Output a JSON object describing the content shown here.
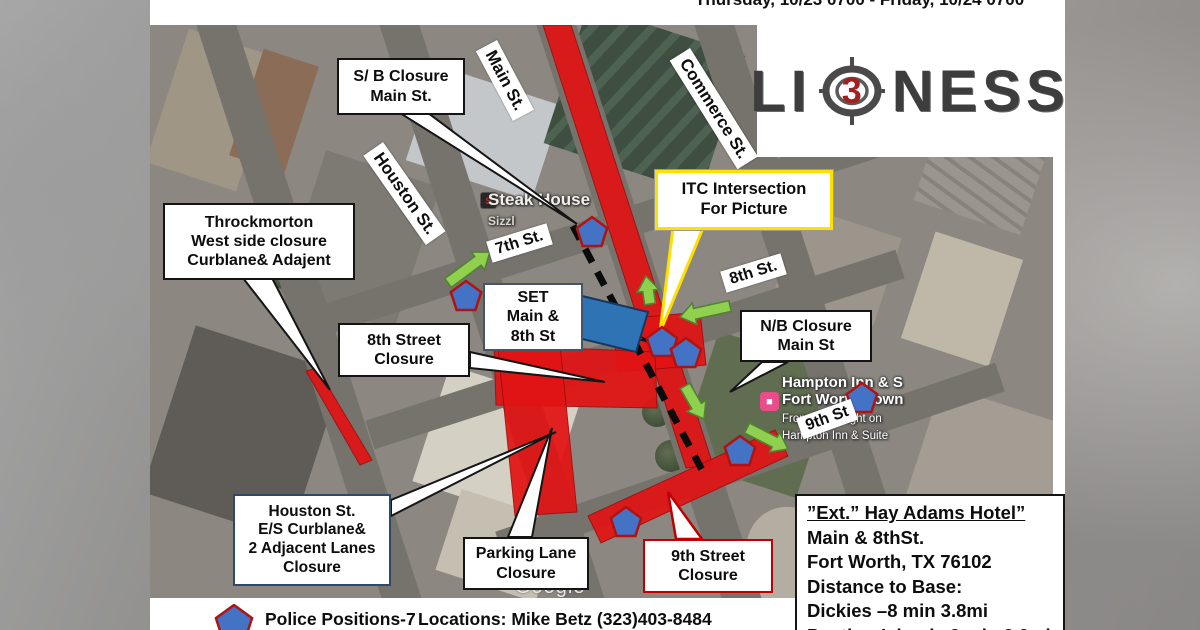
{
  "header": {
    "schedule": "Thursday, 10/23 0700 - Friday, 10/24 0700"
  },
  "logo": {
    "left": "LI",
    "number": "3",
    "right": "NESS",
    "name": "Lioness season 3 logo"
  },
  "callouts": {
    "sb": {
      "lines": [
        "S/ B Closure",
        "Main St."
      ]
    },
    "throck": {
      "lines": [
        "Throckmorton",
        "West side closure",
        "Curblane& Adajent"
      ]
    },
    "itc": {
      "lines": [
        "ITC Intersection",
        "For Picture"
      ]
    },
    "set": {
      "lines": [
        "SET",
        "Main &",
        "8th St"
      ]
    },
    "eighth": {
      "lines": [
        "8th Street",
        "Closure"
      ]
    },
    "nb": {
      "lines": [
        "N/B Closure",
        "Main St"
      ]
    },
    "houston_es": {
      "lines": [
        "Houston St.",
        "E/S Curblane&",
        "2 Adjacent Lanes",
        "Closure"
      ]
    },
    "parking": {
      "lines": [
        "Parking Lane",
        "Closure"
      ]
    },
    "ninth": {
      "lines": [
        "9th Street",
        "Closure"
      ]
    }
  },
  "street_labels": {
    "main": "Main St.",
    "commerce": "Commerce St.",
    "houston": "Houston St.",
    "seventh": "7th St.",
    "eighth": "8th St.",
    "ninth": "9th St"
  },
  "place_labels": {
    "steak_main": "Steak House",
    "steak_sub": "Sizzl",
    "hampton_line1": "Hampton Inn & S",
    "hampton_line2": "Fort Worth Down",
    "hampton_line3": "From $149/night on",
    "hampton_line4": "Hampton Inn & Suite",
    "google": "Google"
  },
  "ext_box": {
    "title": "”Ext.” Hay Adams Hotel”",
    "line1": "Main & 8thSt.",
    "line2": "Fort Worth, TX 76102",
    "line3": "Distance to Base:",
    "line4": "Dickies –8 min 3.8mi",
    "line5": "Panther Island –9 min 3.9mi"
  },
  "legend": {
    "police_label": "Police Positions-7",
    "locations_label": "Locations: Mike Betz (323)403-8484"
  },
  "police": {
    "count": 7,
    "positions": [
      [
        592,
        233
      ],
      [
        466,
        297
      ],
      [
        662,
        343
      ],
      [
        686,
        354
      ],
      [
        740,
        452
      ],
      [
        626,
        523
      ],
      [
        862,
        399
      ]
    ],
    "radius": 16
  },
  "arrows": [
    {
      "from": [
        448,
        283
      ],
      "to": [
        490,
        252
      ]
    },
    {
      "from": [
        650,
        304
      ],
      "to": [
        646,
        276
      ]
    },
    {
      "from": [
        730,
        306
      ],
      "to": [
        680,
        317
      ]
    },
    {
      "from": [
        685,
        386
      ],
      "to": [
        704,
        419
      ]
    },
    {
      "from": [
        747,
        428
      ],
      "to": [
        788,
        449
      ]
    }
  ],
  "colors": {
    "closure_red": "#e11414",
    "police_blue": "#4472c4",
    "police_border": "#b01310",
    "arrow_green": "#8fd14f",
    "arrow_border": "#538135",
    "itc_yellow": "#ffe000",
    "lioness_red": "#a32020"
  }
}
